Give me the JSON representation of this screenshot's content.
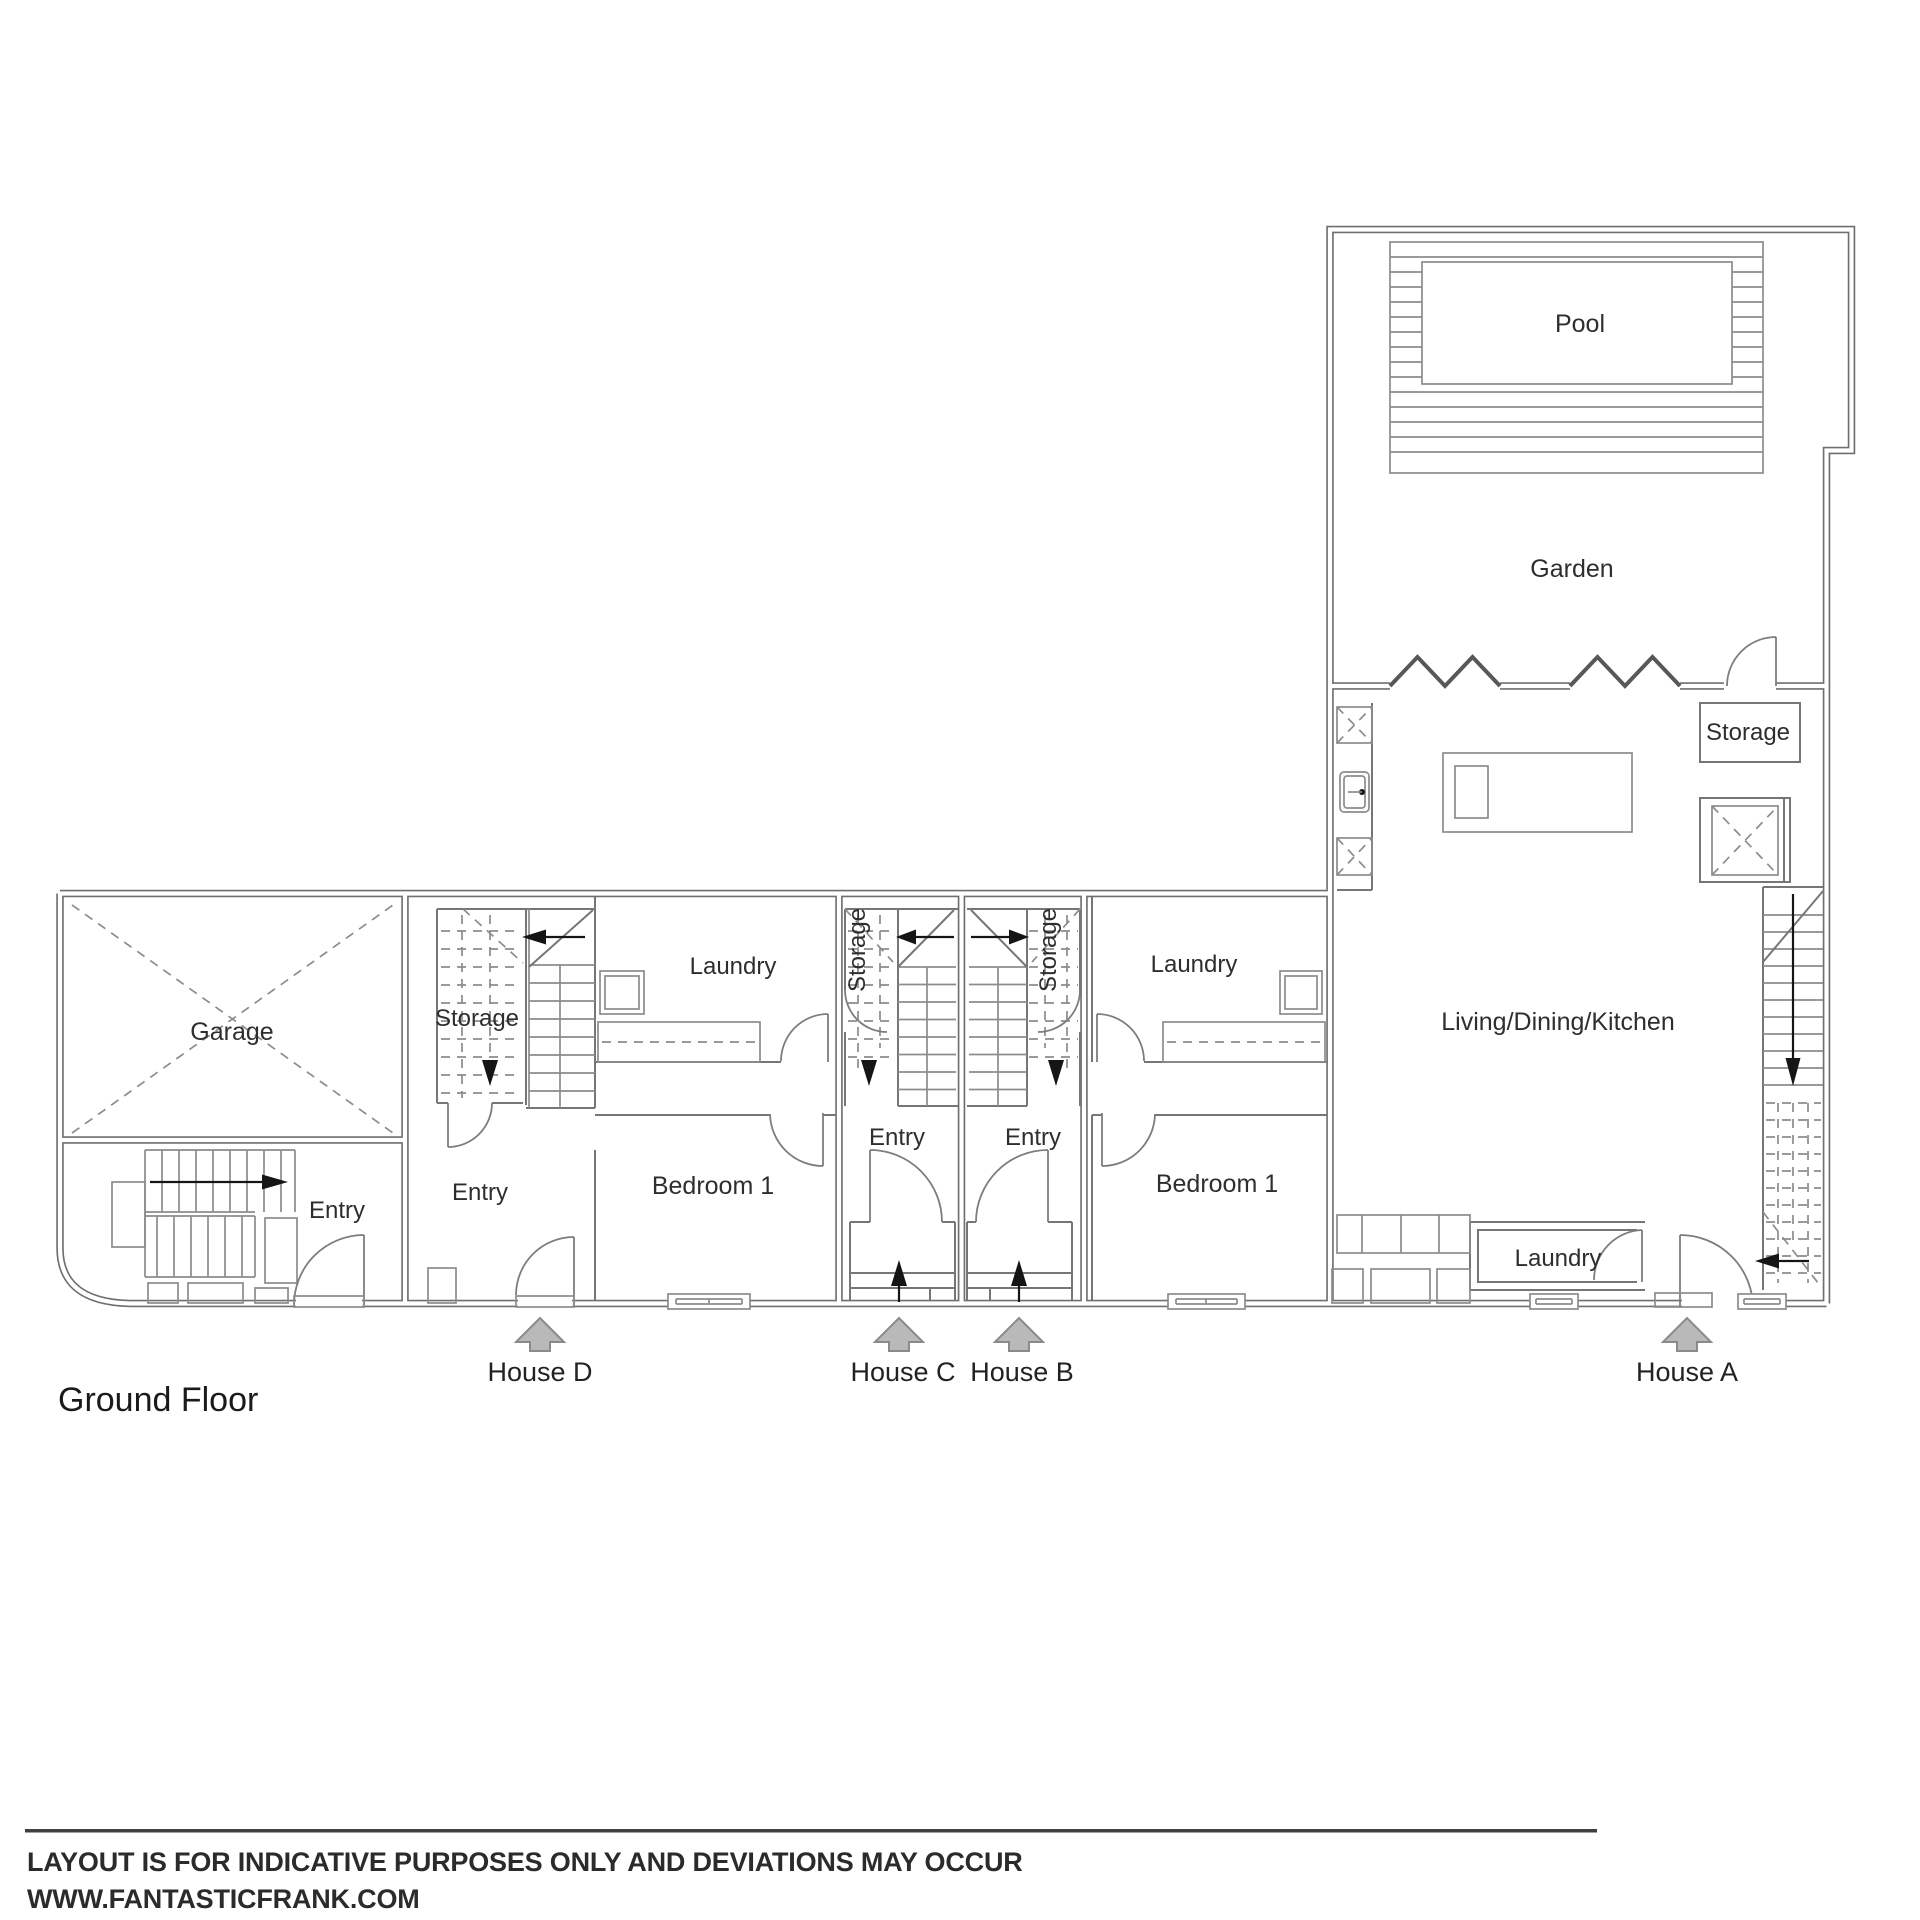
{
  "title": "Ground Floor",
  "plan": {
    "rooms": {
      "garage": "Garage",
      "entry_shared": "Entry",
      "storage_d": "Storage",
      "entry_d": "Entry",
      "laundry_d": "Laundry",
      "bedroom_d": "Bedroom 1",
      "storage_c": "Storage",
      "entry_c": "Entry",
      "storage_b": "Storage",
      "entry_b": "Entry",
      "laundry_b": "Laundry",
      "bedroom_b": "Bedroom 1",
      "living_a": "Living/Dining/Kitchen",
      "laundry_a": "Laundry",
      "storage_a": "Storage",
      "garden": "Garden",
      "pool": "Pool"
    },
    "houses": [
      {
        "id": "house-d",
        "label": "House D"
      },
      {
        "id": "house-c",
        "label": "House C"
      },
      {
        "id": "house-b",
        "label": "House B"
      },
      {
        "id": "house-a",
        "label": "House A"
      }
    ]
  },
  "footer": {
    "disclaimer": "LAYOUT IS FOR INDICATIVE PURPOSES ONLY AND DEVIATIONS MAY OCCUR",
    "website": "WWW.FANTASTICFRANK.COM"
  },
  "colors": {
    "wall": "#6f6f6f",
    "house_marker_fill": "#b9b9b9",
    "house_marker_stroke": "#8a8a8a"
  }
}
